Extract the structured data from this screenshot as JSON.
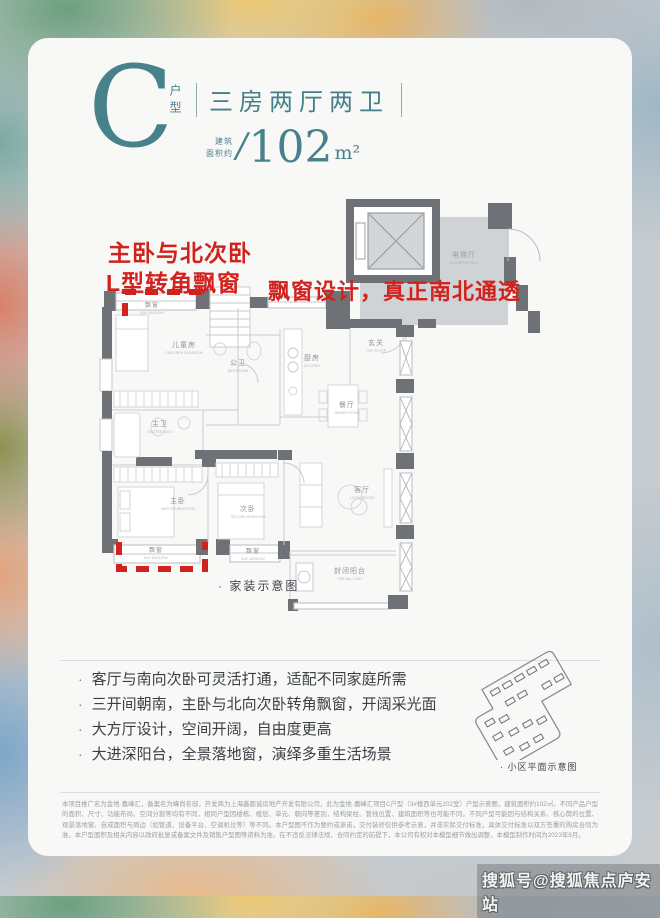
{
  "header": {
    "letter": "C",
    "letter_label": "户型",
    "title": "三房两厅两卫",
    "area_line1": "建筑",
    "area_line2": "面积约",
    "area_slash": "/",
    "area_value": "102",
    "area_unit": "m²",
    "accent_color": "#47828c"
  },
  "annotations": {
    "color": "#d1221e",
    "left_line1": "主卧与北次卧",
    "left_line2": "L型转角飘窗",
    "right": "飘窗设计，真正南北通透"
  },
  "floorplan": {
    "caption": "· 家装示意图",
    "rooms": [
      {
        "cn": "飘窗",
        "en": "BAY WINDOW",
        "x": 64,
        "y": 112,
        "cn_size": 6
      },
      {
        "cn": "儿童房",
        "en": "CHILDREN BEDROOM",
        "x": 96,
        "y": 152,
        "cn_size": 7
      },
      {
        "cn": "公卫",
        "en": "BATHROOM",
        "x": 150,
        "y": 170,
        "cn_size": 7
      },
      {
        "cn": "厨房",
        "en": "KITCHEN",
        "x": 224,
        "y": 165,
        "cn_size": 7
      },
      {
        "cn": "玄关",
        "en": "THE FOYER",
        "x": 288,
        "y": 150,
        "cn_size": 7
      },
      {
        "cn": "电梯厅",
        "en": "ELEVATOR HALL",
        "x": 376,
        "y": 62,
        "cn_size": 7,
        "color": "#9aa0a4"
      },
      {
        "cn": "餐厅",
        "en": "DINING ROOM",
        "x": 259,
        "y": 212,
        "cn_size": 7
      },
      {
        "cn": "主卫",
        "en": "MASTER BATH",
        "x": 72,
        "y": 231,
        "cn_size": 7
      },
      {
        "cn": "主卧",
        "en": "MASTER BEDROOM",
        "x": 90,
        "y": 308,
        "cn_size": 7
      },
      {
        "cn": "次卧",
        "en": "SECOND BEDROOM",
        "x": 160,
        "y": 316,
        "cn_size": 7
      },
      {
        "cn": "客厅",
        "en": "LIVING ROOM",
        "x": 274,
        "y": 297,
        "cn_size": 7
      },
      {
        "cn": "封闭阳台",
        "en": "THE BALCONY",
        "x": 262,
        "y": 378,
        "cn_size": 7
      },
      {
        "cn": "飘窗",
        "en": "BAY WINDOW",
        "x": 68,
        "y": 357,
        "cn_size": 6
      },
      {
        "cn": "飘窗",
        "en": "BAY WINDOW",
        "x": 165,
        "y": 358,
        "cn_size": 6
      }
    ]
  },
  "features": {
    "bullet_char": "·",
    "items": [
      "客厅与南向次卧可灵活打通，适配不同家庭所需",
      "三开间朝南，主卧与北向次卧转角飘窗，开阔采光面",
      "大方厅设计，空间开阔，自由度更高",
      "大进深阳台，全景落地窗，演绎多重生活场景"
    ]
  },
  "siteplan": {
    "caption": "· 小区平面示意图"
  },
  "disclaimer": {
    "text": "本项目推广名为金地·嘉峰汇，备案名为峰尚名邸，开发商为上海鑫都诚房地产开发有限公司，此为金地·嘉峰汇项目C户型（3#楼西单元202室）户型示意图，建筑面积约102㎡。不同产品户型的面积、尺寸、功能布局、空间分割等均有不同，相同户型因楼栋、楼层、单元、朝向等差别，结构梁柱、管线位置、建筑面积等也可能不同。不同户型可能因与结构关系、核心筒的位置、观景落地窗、自成面积与周边（如管道、设备平台、空调机位等）等不同。本户型图不作为要约或承诺，交付装修仅供参考示意，并非实际交付标准，具体交付标准以双方签署的购房合同为准。本户型面积及相关内容以政府批复或备案文件及销售户型图等资料为准。在不违反法律法规、合同约定的前提下，本公司有权对本模型细节做出调整，本模型制作时间为2023年8月。"
  },
  "watermark": {
    "text": "搜狐号@搜狐焦点庐安站"
  }
}
